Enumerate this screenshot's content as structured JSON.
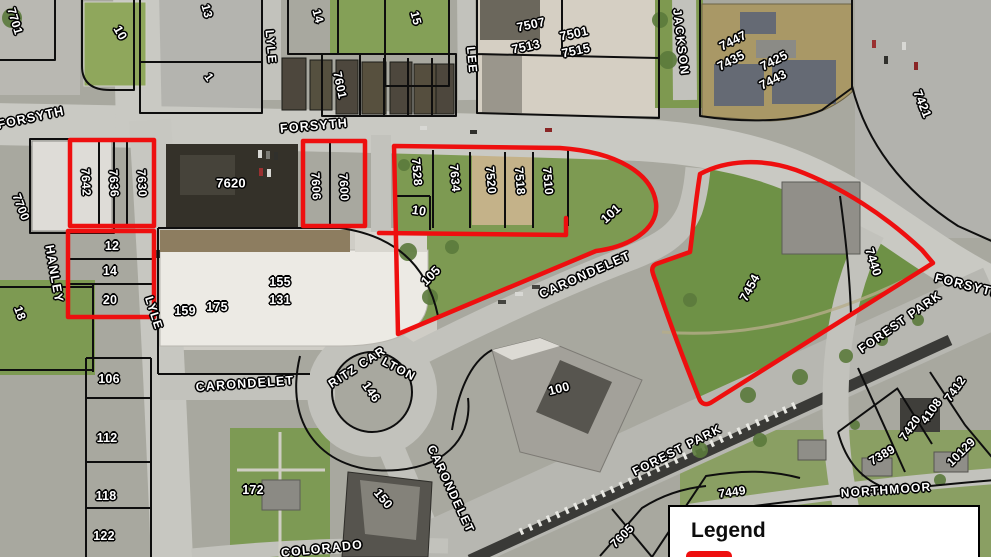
{
  "colors": {
    "highlight_red": "#ee0f0f",
    "parcel_line": "#0e0e0e",
    "label_fill": "#ffffff"
  },
  "legend": {
    "title": "Legend"
  },
  "highlighted_parcels": [
    "7642",
    "7636",
    "7630",
    "7606",
    "7600",
    "12",
    "14",
    "20",
    "7528",
    "7634",
    "7520",
    "7518",
    "7510",
    "10",
    "101",
    "105",
    "7454",
    "7440"
  ],
  "map_labels": [
    {
      "name": "street-forsyth-west",
      "kind": "street",
      "text": "FORSYTH",
      "x": 31,
      "y": 118,
      "rot": -12,
      "fs": 12.5
    },
    {
      "name": "street-forsyth-mid",
      "kind": "street",
      "text": "FORSYTH",
      "x": 314,
      "y": 126,
      "rot": -5,
      "fs": 12.5
    },
    {
      "name": "street-forsyth-east",
      "kind": "street",
      "text": "FORSYTH",
      "x": 968,
      "y": 286,
      "rot": 14,
      "fs": 12.5
    },
    {
      "name": "street-hanley",
      "kind": "street",
      "text": "HANLEY",
      "x": 54,
      "y": 274,
      "rot": 80,
      "fs": 12.5
    },
    {
      "name": "street-lyle-north",
      "kind": "street",
      "text": "LYLE",
      "x": 271,
      "y": 47,
      "rot": 85,
      "fs": 12
    },
    {
      "name": "street-lyle-south",
      "kind": "street",
      "text": "LYLE",
      "x": 154,
      "y": 313,
      "rot": 72,
      "fs": 12
    },
    {
      "name": "street-lee",
      "kind": "street",
      "text": "LEE",
      "x": 472,
      "y": 60,
      "rot": 85,
      "fs": 12
    },
    {
      "name": "street-jackson",
      "kind": "street",
      "text": "JACKSON",
      "x": 681,
      "y": 42,
      "rot": 83,
      "fs": 12
    },
    {
      "name": "street-carondelet-ne",
      "kind": "street",
      "text": "CARONDELET",
      "x": 585,
      "y": 275,
      "rot": -24,
      "fs": 12.5
    },
    {
      "name": "street-carondelet-west",
      "kind": "street",
      "text": "CARONDELET",
      "x": 245,
      "y": 384,
      "rot": -4,
      "fs": 12.5
    },
    {
      "name": "street-carondelet-south",
      "kind": "street",
      "text": "CARONDELET",
      "x": 451,
      "y": 489,
      "rot": 65,
      "fs": 12
    },
    {
      "name": "street-ritz-carlton-1",
      "kind": "street",
      "text": "RITZ CAR",
      "x": 357,
      "y": 367,
      "rot": -33,
      "fs": 12
    },
    {
      "name": "street-ritz-carlton-2",
      "kind": "street",
      "text": "LTON",
      "x": 399,
      "y": 369,
      "rot": 28,
      "fs": 12
    },
    {
      "name": "street-forest-park-ne",
      "kind": "street",
      "text": "FOREST PARK",
      "x": 900,
      "y": 322,
      "rot": -35,
      "fs": 12
    },
    {
      "name": "street-forest-park-sw",
      "kind": "street",
      "text": "FOREST PARK",
      "x": 677,
      "y": 450,
      "rot": -27,
      "fs": 12
    },
    {
      "name": "street-colorado",
      "kind": "street",
      "text": "COLORADO",
      "x": 322,
      "y": 549,
      "rot": -6,
      "fs": 12.5
    },
    {
      "name": "street-northmoor",
      "kind": "street",
      "text": "NORTHMOOR",
      "x": 886,
      "y": 490,
      "rot": -4,
      "fs": 12
    },
    {
      "name": "parcel-7701",
      "kind": "parcel",
      "text": "7701",
      "x": 15,
      "y": 21,
      "rot": 73,
      "fs": 12
    },
    {
      "name": "parcel-10-north",
      "kind": "parcel",
      "text": "10",
      "x": 120,
      "y": 33,
      "rot": 60,
      "fs": 12.5
    },
    {
      "name": "parcel-13",
      "kind": "parcel",
      "text": "13",
      "x": 207,
      "y": 11,
      "rot": 75,
      "fs": 12
    },
    {
      "name": "parcel-1",
      "kind": "parcel",
      "text": "1",
      "x": 209,
      "y": 77,
      "rot": 55,
      "fs": 12
    },
    {
      "name": "parcel-14-north",
      "kind": "parcel",
      "text": "14",
      "x": 318,
      "y": 16,
      "rot": 75,
      "fs": 12
    },
    {
      "name": "parcel-15",
      "kind": "parcel",
      "text": "15",
      "x": 416,
      "y": 18,
      "rot": 75,
      "fs": 12
    },
    {
      "name": "parcel-7601",
      "kind": "parcel",
      "text": "7601",
      "x": 340,
      "y": 85,
      "rot": 78,
      "fs": 12
    },
    {
      "name": "parcel-7507",
      "kind": "parcel",
      "text": "7507",
      "x": 531,
      "y": 25,
      "rot": -12,
      "fs": 12.5
    },
    {
      "name": "parcel-7513",
      "kind": "parcel",
      "text": "7513",
      "x": 526,
      "y": 47,
      "rot": -12,
      "fs": 12.5
    },
    {
      "name": "parcel-7501",
      "kind": "parcel",
      "text": "7501",
      "x": 574,
      "y": 34,
      "rot": -12,
      "fs": 12.5
    },
    {
      "name": "parcel-7515",
      "kind": "parcel",
      "text": "7515",
      "x": 576,
      "y": 51,
      "rot": -12,
      "fs": 12.5
    },
    {
      "name": "parcel-7447",
      "kind": "parcel",
      "text": "7447",
      "x": 733,
      "y": 41,
      "rot": -27,
      "fs": 12.5
    },
    {
      "name": "parcel-7435",
      "kind": "parcel",
      "text": "7435",
      "x": 731,
      "y": 61,
      "rot": -27,
      "fs": 12.5
    },
    {
      "name": "parcel-7425",
      "kind": "parcel",
      "text": "7425",
      "x": 774,
      "y": 61,
      "rot": -27,
      "fs": 12.5
    },
    {
      "name": "parcel-7443",
      "kind": "parcel",
      "text": "7443",
      "x": 773,
      "y": 80,
      "rot": -27,
      "fs": 12.5
    },
    {
      "name": "parcel-7421",
      "kind": "parcel",
      "text": "7421",
      "x": 922,
      "y": 104,
      "rot": 68,
      "fs": 12.5
    },
    {
      "name": "parcel-7642",
      "kind": "parcel",
      "text": "7642",
      "x": 86,
      "y": 182,
      "rot": 87,
      "fs": 12
    },
    {
      "name": "parcel-7636",
      "kind": "parcel",
      "text": "7636",
      "x": 114,
      "y": 183,
      "rot": 87,
      "fs": 12
    },
    {
      "name": "parcel-7630",
      "kind": "parcel",
      "text": "7630",
      "x": 142,
      "y": 183,
      "rot": 87,
      "fs": 12
    },
    {
      "name": "parcel-7620",
      "kind": "parcel",
      "text": "7620",
      "x": 231,
      "y": 183,
      "rot": 0,
      "fs": 13
    },
    {
      "name": "parcel-7606",
      "kind": "parcel",
      "text": "7606",
      "x": 316,
      "y": 186,
      "rot": 87,
      "fs": 12
    },
    {
      "name": "parcel-7600",
      "kind": "parcel",
      "text": "7600",
      "x": 344,
      "y": 187,
      "rot": 87,
      "fs": 12
    },
    {
      "name": "parcel-12",
      "kind": "parcel",
      "text": "12",
      "x": 112,
      "y": 246,
      "rot": 0,
      "fs": 12.5
    },
    {
      "name": "parcel-14-mid",
      "kind": "parcel",
      "text": "14",
      "x": 110,
      "y": 271,
      "rot": 0,
      "fs": 12.5
    },
    {
      "name": "parcel-20",
      "kind": "parcel",
      "text": "20",
      "x": 110,
      "y": 300,
      "rot": 0,
      "fs": 12.5
    },
    {
      "name": "parcel-7528",
      "kind": "parcel",
      "text": "7528",
      "x": 417,
      "y": 172,
      "rot": 85,
      "fs": 12
    },
    {
      "name": "parcel-7634",
      "kind": "parcel",
      "text": "7634",
      "x": 455,
      "y": 178,
      "rot": 85,
      "fs": 12
    },
    {
      "name": "parcel-7520",
      "kind": "parcel",
      "text": "7520",
      "x": 491,
      "y": 180,
      "rot": 85,
      "fs": 12
    },
    {
      "name": "parcel-7518",
      "kind": "parcel",
      "text": "7518",
      "x": 520,
      "y": 181,
      "rot": 85,
      "fs": 12
    },
    {
      "name": "parcel-7510",
      "kind": "parcel",
      "text": "7510",
      "x": 548,
      "y": 181,
      "rot": 85,
      "fs": 12
    },
    {
      "name": "parcel-10-mid",
      "kind": "parcel",
      "text": "10",
      "x": 419,
      "y": 211,
      "rot": 8,
      "fs": 12.5
    },
    {
      "name": "parcel-101-ne",
      "kind": "parcel",
      "text": "101",
      "x": 611,
      "y": 214,
      "rot": -42,
      "fs": 12.5
    },
    {
      "name": "parcel-105",
      "kind": "parcel",
      "text": "105",
      "x": 431,
      "y": 276,
      "rot": -45,
      "fs": 12.5
    },
    {
      "name": "parcel-7454",
      "kind": "parcel",
      "text": "7454",
      "x": 750,
      "y": 288,
      "rot": -62,
      "fs": 12.5
    },
    {
      "name": "parcel-7440",
      "kind": "parcel",
      "text": "7440",
      "x": 873,
      "y": 262,
      "rot": 72,
      "fs": 12.5
    },
    {
      "name": "parcel-7700",
      "kind": "parcel",
      "text": "7700",
      "x": 21,
      "y": 207,
      "rot": 69,
      "fs": 12
    },
    {
      "name": "parcel-18",
      "kind": "parcel",
      "text": "18",
      "x": 20,
      "y": 313,
      "rot": 70,
      "fs": 12
    },
    {
      "name": "parcel-155",
      "kind": "parcel",
      "text": "155",
      "x": 280,
      "y": 282,
      "rot": 0,
      "fs": 12.5
    },
    {
      "name": "parcel-131",
      "kind": "parcel",
      "text": "131",
      "x": 280,
      "y": 300,
      "rot": 0,
      "fs": 12.5
    },
    {
      "name": "parcel-159",
      "kind": "parcel",
      "text": "159",
      "x": 185,
      "y": 311,
      "rot": 0,
      "fs": 12.5
    },
    {
      "name": "parcel-175",
      "kind": "parcel",
      "text": "175",
      "x": 217,
      "y": 307,
      "rot": 0,
      "fs": 12.5
    },
    {
      "name": "parcel-106",
      "kind": "parcel",
      "text": "106",
      "x": 109,
      "y": 379,
      "rot": 0,
      "fs": 12.5
    },
    {
      "name": "parcel-112",
      "kind": "parcel",
      "text": "112",
      "x": 107,
      "y": 438,
      "rot": 0,
      "fs": 12.5
    },
    {
      "name": "parcel-118",
      "kind": "parcel",
      "text": "118",
      "x": 106,
      "y": 496,
      "rot": 0,
      "fs": 12.5
    },
    {
      "name": "parcel-122",
      "kind": "parcel",
      "text": "122",
      "x": 104,
      "y": 536,
      "rot": 0,
      "fs": 12.5
    },
    {
      "name": "parcel-172",
      "kind": "parcel",
      "text": "172",
      "x": 253,
      "y": 490,
      "rot": 0,
      "fs": 12.5
    },
    {
      "name": "parcel-146",
      "kind": "parcel",
      "text": "146",
      "x": 371,
      "y": 392,
      "rot": 55,
      "fs": 12.5
    },
    {
      "name": "parcel-150",
      "kind": "parcel",
      "text": "150",
      "x": 383,
      "y": 499,
      "rot": 50,
      "fs": 12.5
    },
    {
      "name": "parcel-100",
      "kind": "parcel",
      "text": "100",
      "x": 559,
      "y": 389,
      "rot": -14,
      "fs": 12.5
    },
    {
      "name": "parcel-7412",
      "kind": "parcel",
      "text": "7412",
      "x": 955,
      "y": 389,
      "rot": -55,
      "fs": 12
    },
    {
      "name": "parcel-4108",
      "kind": "parcel",
      "text": "4108",
      "x": 931,
      "y": 411,
      "rot": -55,
      "fs": 12
    },
    {
      "name": "parcel-7420",
      "kind": "parcel",
      "text": "7420",
      "x": 910,
      "y": 428,
      "rot": -55,
      "fs": 12
    },
    {
      "name": "parcel-7389",
      "kind": "parcel",
      "text": "7389",
      "x": 882,
      "y": 455,
      "rot": -30,
      "fs": 12
    },
    {
      "name": "parcel-10129",
      "kind": "parcel",
      "text": "10129",
      "x": 961,
      "y": 452,
      "rot": -45,
      "fs": 12
    },
    {
      "name": "parcel-7449",
      "kind": "parcel",
      "text": "7449",
      "x": 732,
      "y": 492,
      "rot": -8,
      "fs": 12
    },
    {
      "name": "parcel-7605",
      "kind": "parcel",
      "text": "7605",
      "x": 622,
      "y": 536,
      "rot": -45,
      "fs": 12
    }
  ]
}
